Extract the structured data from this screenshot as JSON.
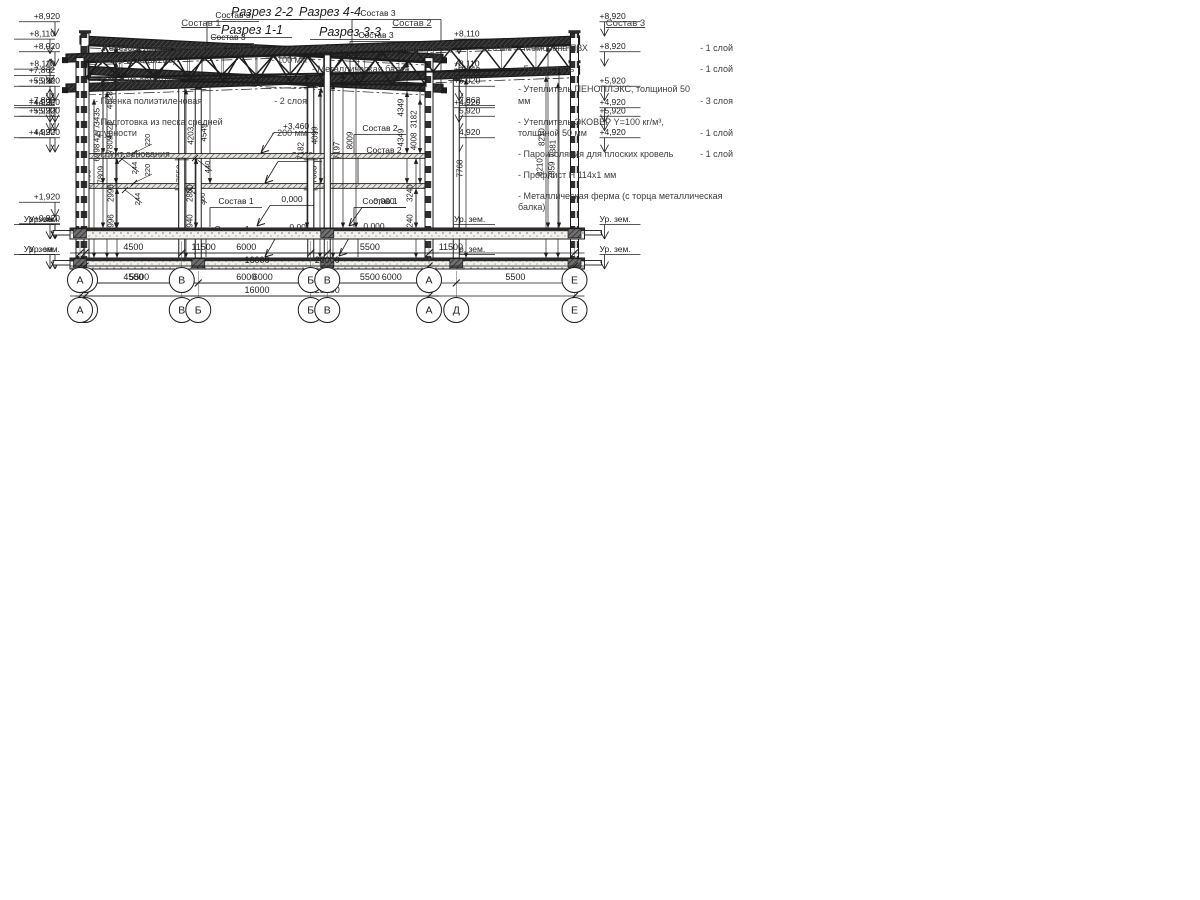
{
  "page": {
    "background": "#ffffff",
    "ink": "#1c1c1c"
  },
  "sections": [
    {
      "id": "s11",
      "title": "Разрез 1-1",
      "axes": [
        "Г",
        "В",
        "Б",
        "А"
      ],
      "axes_mm": [
        0,
        4500,
        10500,
        16000
      ],
      "spans": [
        "4500",
        "6000",
        "5500"
      ],
      "total": "16000",
      "total_mm": 16000,
      "roof_mm": [
        8920,
        8110
      ],
      "floor_mm": [
        3460,
        220
      ],
      "marks_left": [
        [
          "+8,920",
          8920,
          "d"
        ],
        [
          "+5,920",
          5920,
          "d"
        ],
        [
          "+4,920",
          4920,
          "d"
        ],
        [
          "+1,920",
          1920,
          "d"
        ],
        [
          "+0,920",
          920,
          "d"
        ],
        [
          "Ур. зем.",
          "g",
          "d"
        ]
      ],
      "marks_right": [
        [
          "+8,110",
          8110,
          "d"
        ],
        [
          "+7,862",
          7862,
          "u"
        ],
        [
          "+5,920",
          5920,
          "d"
        ],
        [
          "+4,920",
          4920,
          "d"
        ],
        [
          "Ур. зем.",
          "g",
          "d"
        ]
      ],
      "columns_lower_mm": [
        4500,
        10500
      ],
      "columns_upper_mm": [
        4500,
        10500
      ],
      "columns_full_mm": [],
      "truss": [],
      "vdims": [
        [
          "4277",
          18,
          "f",
          "r",
          1
        ],
        [
          "4628",
          31,
          "f",
          "r",
          0
        ],
        [
          "4203",
          112,
          "f",
          "r",
          1
        ],
        [
          "4549",
          125,
          "f",
          "r",
          0
        ],
        [
          "4099",
          236,
          "f",
          "r",
          0
        ],
        [
          "4349",
          322,
          "f",
          "r",
          0
        ],
        [
          "4008",
          335,
          "f",
          "r",
          1
        ],
        [
          "2996",
          32,
          "g",
          "fb",
          0
        ],
        [
          "2940",
          111,
          "g",
          "fb",
          0
        ],
        [
          "3240",
          331,
          "g",
          "fb",
          0
        ]
      ],
      "minis": [
        [
          "220",
          150,
          170,
          134,
          183
        ],
        [
          "244",
          140,
          199,
          125,
          190
        ],
        [
          "300",
          205,
          199,
          190,
          190
        ]
      ],
      "callouts": [
        [
          "Состав 3",
          376,
          38,
          "bracket",
          0
        ],
        [
          "Состав 2",
          384,
          153,
          "drop",
          183
        ],
        [
          "Состав 1",
          384,
          234,
          "drop",
          257
        ],
        [
          "+3,460",
          300,
          158,
          "arrow",
          183
        ],
        [
          "0,000",
          300,
          230,
          "arrow",
          257
        ]
      ]
    },
    {
      "id": "s33",
      "title": "Разрез 3-3",
      "axes": [
        "А",
        "Б",
        "В",
        "Д",
        "Е"
      ],
      "axes_mm": [
        0,
        5500,
        11500,
        17500,
        23000
      ],
      "spans": [
        "5500",
        "6000",
        "6000",
        "5500"
      ],
      "total": "23000",
      "total_mm": 23000,
      "roof_mm": [
        8110,
        8920
      ],
      "floor_mm": null,
      "marks_left": [
        [
          "+8,110",
          8110,
          "d"
        ],
        [
          "+7,862",
          7862,
          "u"
        ],
        [
          "+5,920",
          5920,
          "d"
        ],
        [
          "+4,920",
          4920,
          "d"
        ],
        [
          "Ур. зем.",
          "g",
          "d"
        ]
      ],
      "marks_right": [
        [
          "+8,920",
          8920,
          "d"
        ],
        [
          "+5,920",
          5920,
          "d"
        ],
        [
          "+4,920",
          4920,
          "d"
        ],
        [
          "Ур. зем.",
          "g",
          "d"
        ]
      ],
      "columns_lower_mm": [],
      "columns_upper_mm": [],
      "columns_full_mm": [
        5500,
        11500,
        17500
      ],
      "truss": [],
      "vdims": [
        [
          "7468",
          14,
          "g",
          "r",
          1
        ],
        [
          "7809",
          27,
          "g",
          "r",
          0
        ],
        [
          "7558",
          106,
          "g",
          "r",
          0
        ],
        [
          "7663",
          240,
          "g",
          "r",
          1
        ],
        [
          "8009",
          253,
          "g",
          "r",
          0
        ],
        [
          "7768",
          386,
          "g",
          "r",
          0
        ],
        [
          "8210",
          466,
          "g",
          "r",
          0
        ],
        [
          "7859",
          478,
          "g",
          "r",
          1
        ]
      ],
      "minis": [],
      "callouts": [
        [
          "Состав 3",
          228,
          40,
          "drop",
          -1
        ],
        [
          "Состав 1",
          232,
          232,
          "drop",
          257
        ],
        [
          "0,000",
          374,
          229,
          "arrow",
          256
        ]
      ]
    },
    {
      "id": "s22",
      "title": "Разрез 2-2",
      "axes": [
        "Г",
        "В",
        "Б",
        "А"
      ],
      "axes_mm": [
        0,
        4500,
        10500,
        16000
      ],
      "spans": [
        "4500",
        "6000",
        "5500"
      ],
      "total": "16000",
      "total_mm": 16000,
      "roof_mm": [
        8920,
        8110
      ],
      "floor_mm": [
        3460,
        220
      ],
      "marks_left": [
        [
          "+8,920",
          8920,
          "d"
        ],
        [
          "+5,920",
          5920,
          "d"
        ],
        [
          "+4,920",
          4920,
          "d"
        ],
        [
          "Ур. зем.",
          "g",
          "d"
        ]
      ],
      "marks_right": [
        [
          "+8,110",
          8110,
          "d"
        ],
        [
          "+7,862",
          7862,
          "u"
        ],
        [
          "+5,920",
          5920,
          "d"
        ],
        [
          "+4,920",
          4920,
          "d"
        ],
        [
          "Ур. зем.",
          "g",
          "d"
        ]
      ],
      "columns_lower_mm": [
        4500,
        10500
      ],
      "columns_upper_mm": [],
      "columns_full_mm": [],
      "truss": [
        [
          150,
          15850,
          6895,
          6642
        ]
      ],
      "vdims": [
        [
          "3435",
          18,
          "f",
          "tb",
          0
        ],
        [
          "4628",
          31,
          "f",
          "r",
          0
        ],
        [
          "4349",
          322,
          "f",
          "r",
          0
        ],
        [
          "3182",
          335,
          "f",
          "tb",
          0
        ],
        [
          "2996",
          32,
          "g",
          "fb",
          0
        ],
        [
          "2800",
          111,
          "g",
          "fb",
          0
        ],
        [
          "3240",
          331,
          "g",
          "fb",
          0
        ]
      ],
      "minis": [
        [
          "220",
          150,
          140,
          134,
          153
        ],
        [
          "244",
          137,
          168,
          122,
          159
        ],
        [
          "440",
          210,
          167,
          195,
          158
        ]
      ],
      "callouts": [
        [
          "Состав 3",
          378,
          16,
          "bracket",
          0
        ],
        [
          "Состав 2",
          380,
          131,
          "drop",
          153
        ],
        [
          "+3,460",
          296,
          129,
          "arrow",
          153
        ],
        [
          "Состав 1",
          380,
          204,
          "drop",
          227
        ],
        [
          "0,000",
          292,
          202,
          "arrow",
          226
        ]
      ]
    },
    {
      "id": "s44",
      "title": "Разрез 4-4",
      "axes": [
        "А",
        "В",
        "Е"
      ],
      "axes_mm": [
        0,
        11500,
        23000
      ],
      "spans": [
        "11500",
        "11500"
      ],
      "total": "23000",
      "total_mm": 23000,
      "roof_mm": [
        8110,
        8920
      ],
      "floor_mm": null,
      "marks_left": [
        [
          "+8,110",
          8110,
          "d"
        ],
        [
          "+7,862",
          7862,
          "u"
        ],
        [
          "+5,920",
          5920,
          "d"
        ],
        [
          "+4,920",
          4920,
          "d"
        ],
        [
          "Ур. зем.",
          "g",
          "d"
        ]
      ],
      "marks_right": [
        [
          "+8,920",
          8920,
          "d"
        ],
        [
          "+5,920",
          5920,
          "d"
        ],
        [
          "+4,920",
          4920,
          "d"
        ],
        [
          "Ур. зем.",
          "g",
          "d"
        ]
      ],
      "columns_lower_mm": [],
      "columns_upper_mm": [],
      "columns_full_mm": [
        11500
      ],
      "truss": [
        [
          260,
          11350,
          6998,
          7182
        ],
        [
          11650,
          22800,
          7197,
          7381
        ]
      ],
      "vdims": [
        [
          "6998",
          23,
          "g",
          "tb",
          0
        ],
        [
          "7809",
          36,
          "g",
          "r",
          0
        ],
        [
          "7182",
          227,
          "g",
          "tb",
          0
        ],
        [
          "7197",
          263,
          "g",
          "tb",
          0
        ],
        [
          "8009",
          276,
          "g",
          "r",
          0
        ],
        [
          "8210",
          468,
          "g",
          "r",
          0
        ],
        [
          "7381",
          479,
          "g",
          "tb",
          0
        ]
      ],
      "minis": [],
      "callouts": [
        [
          "Состав 3",
          233,
          18,
          "drop",
          -1
        ],
        [
          "Состав 1",
          236,
          204,
          "drop",
          227
        ],
        [
          "0,000",
          384,
          204,
          "arrow",
          226
        ]
      ]
    }
  ],
  "legend": {
    "columns": [
      {
        "title": "Состав 1",
        "items": [
          {
            "text": "- Железобетонная  монолитная плита из бетона В 15 (М200)",
            "value": "- 100 мм"
          },
          {
            "text": "- Сетка из арматуры",
            "value": ""
          },
          {
            "text": "- Пленка полиэтиленовая",
            "value": "- 2 слоя"
          },
          {
            "text": "- Подготовка из песка средней крупности",
            "value": "- 200 мм"
          },
          {
            "text": "- Грунт основания",
            "value": ""
          }
        ]
      },
      {
        "title": "Состав 2",
        "items": [
          {
            "text": "- Сборные ж/б плиты перекрытия",
            "value": "- 220 мм"
          },
          {
            "text": "- Металлическая балка",
            "value": ""
          }
        ]
      },
      {
        "title": "Состав 3",
        "items": [
          {
            "text": "- Мембрана ПВХ",
            "value": "- 1 слой"
          },
          {
            "text": "- Геотекстиль",
            "value": "- 1 слой"
          },
          {
            "text": "- Утеплитель ПЕНОПЛЭКС, толщиной 50 мм",
            "value": "- 3 слоя"
          },
          {
            "text": "- Утеплитель ЭКОВЕР Y=100 кг/м³, толщиной 50 мм",
            "value": "- 1 слой"
          },
          {
            "text": "- Пароизоляция для плоских кровель",
            "value": "- 1 слой"
          },
          {
            "text": "- Профлист Н 114х1 мм",
            "value": ""
          },
          {
            "text": "- Металлическая ферма (с торца металлическая балка)",
            "value": ""
          }
        ]
      }
    ]
  }
}
